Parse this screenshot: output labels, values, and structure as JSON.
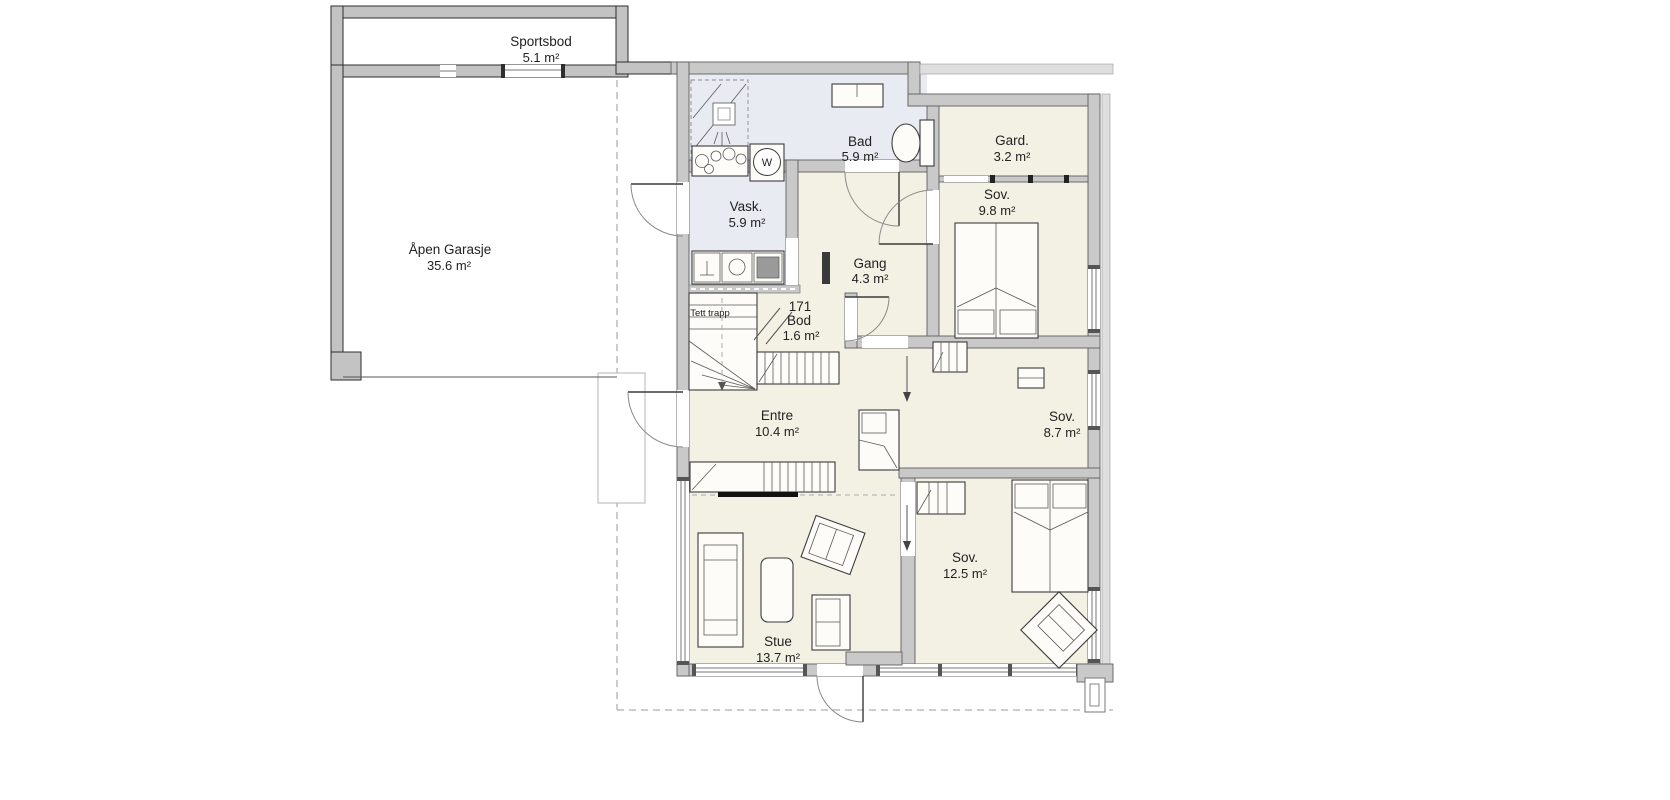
{
  "rooms": [
    {
      "id": "sportsbod",
      "name": "Sportsbod",
      "area": "5.1 m²"
    },
    {
      "id": "garasje",
      "name": "Åpen Garasje",
      "area": "35.6 m²"
    },
    {
      "id": "bad",
      "name": "Bad",
      "area": "5.9 m²"
    },
    {
      "id": "gard",
      "name": "Gard.",
      "area": "3.2 m²"
    },
    {
      "id": "vask",
      "name": "Vask.",
      "area": "5.9 m²"
    },
    {
      "id": "sov-9-8",
      "name": "Sov.",
      "area": "9.8 m²"
    },
    {
      "id": "gang",
      "name": "Gang",
      "area": "4.3 m²"
    },
    {
      "id": "bod",
      "number": "171",
      "name": "Bod",
      "area": "1.6 m²"
    },
    {
      "id": "entre",
      "name": "Entre",
      "area": "10.4 m²"
    },
    {
      "id": "sov-8-7",
      "name": "Sov.",
      "area": "8.7 m²"
    },
    {
      "id": "sov-12-5",
      "name": "Sov.",
      "area": "12.5 m²"
    },
    {
      "id": "stue",
      "name": "Stue",
      "area": "13.7 m²"
    }
  ],
  "annotations": {
    "stairs_label": "Tett trapp",
    "washer_label": "W"
  },
  "colors": {
    "wall": "#c9c9c9",
    "room_floor": "#f3f0e4",
    "wet_room_floor": "#e9ebf2",
    "outline": "#5f5f5f",
    "background": "#ffffff"
  }
}
